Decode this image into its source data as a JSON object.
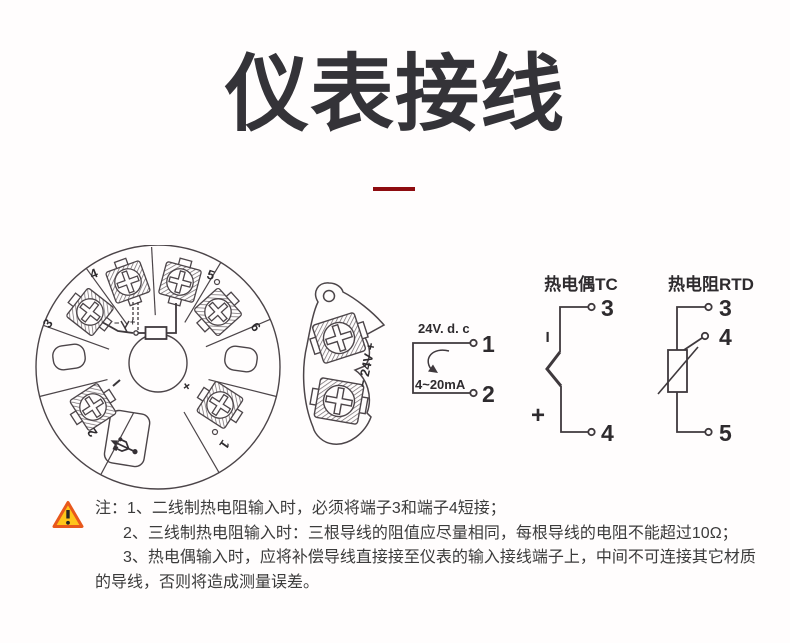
{
  "page": {
    "title": "仪表接线",
    "background": "#fffdfd",
    "accent_color": "#8e0c10",
    "line_color": "#4c4549"
  },
  "head_view": {
    "description": "terminal-head-top-view",
    "terminals": {
      "t1": "1",
      "t2": "2",
      "t3": "3",
      "t4": "4",
      "t5": "5",
      "t6": "6"
    },
    "plus": "+",
    "minus": "−",
    "meter_minus": "−",
    "meter_plus": "+",
    "usb_icon": "usb-icon"
  },
  "side_view": {
    "label": "− 24V +"
  },
  "loop_diagram": {
    "supply_label": "24V. d. c",
    "signal_label": "4~20mA",
    "terminal_1": "1",
    "terminal_2": "2"
  },
  "tc_diagram": {
    "heading": "热电偶TC",
    "terminal_top": "3",
    "terminal_bottom": "4",
    "minus": "−",
    "plus": "+"
  },
  "rtd_diagram": {
    "heading": "热电阻RTD",
    "terminal_top": "3",
    "terminal_mid": "4",
    "terminal_bottom": "5"
  },
  "notes": {
    "prefix": "注：",
    "items": [
      "1、二线制热电阻输入时，必须将端子3和端子4短接；",
      "2、三线制热电阻输入时：三根导线的阻值应尽量相同，每根导线的电阻不能超过10Ω；",
      "3、热电偶输入时，应将补偿导线直接接至仪表的输入接线端子上，中间不可连接其它材质的导线，否则将造成测量误差。"
    ],
    "warning_fill": "#ffc41a",
    "warning_border": "#e8581c"
  }
}
